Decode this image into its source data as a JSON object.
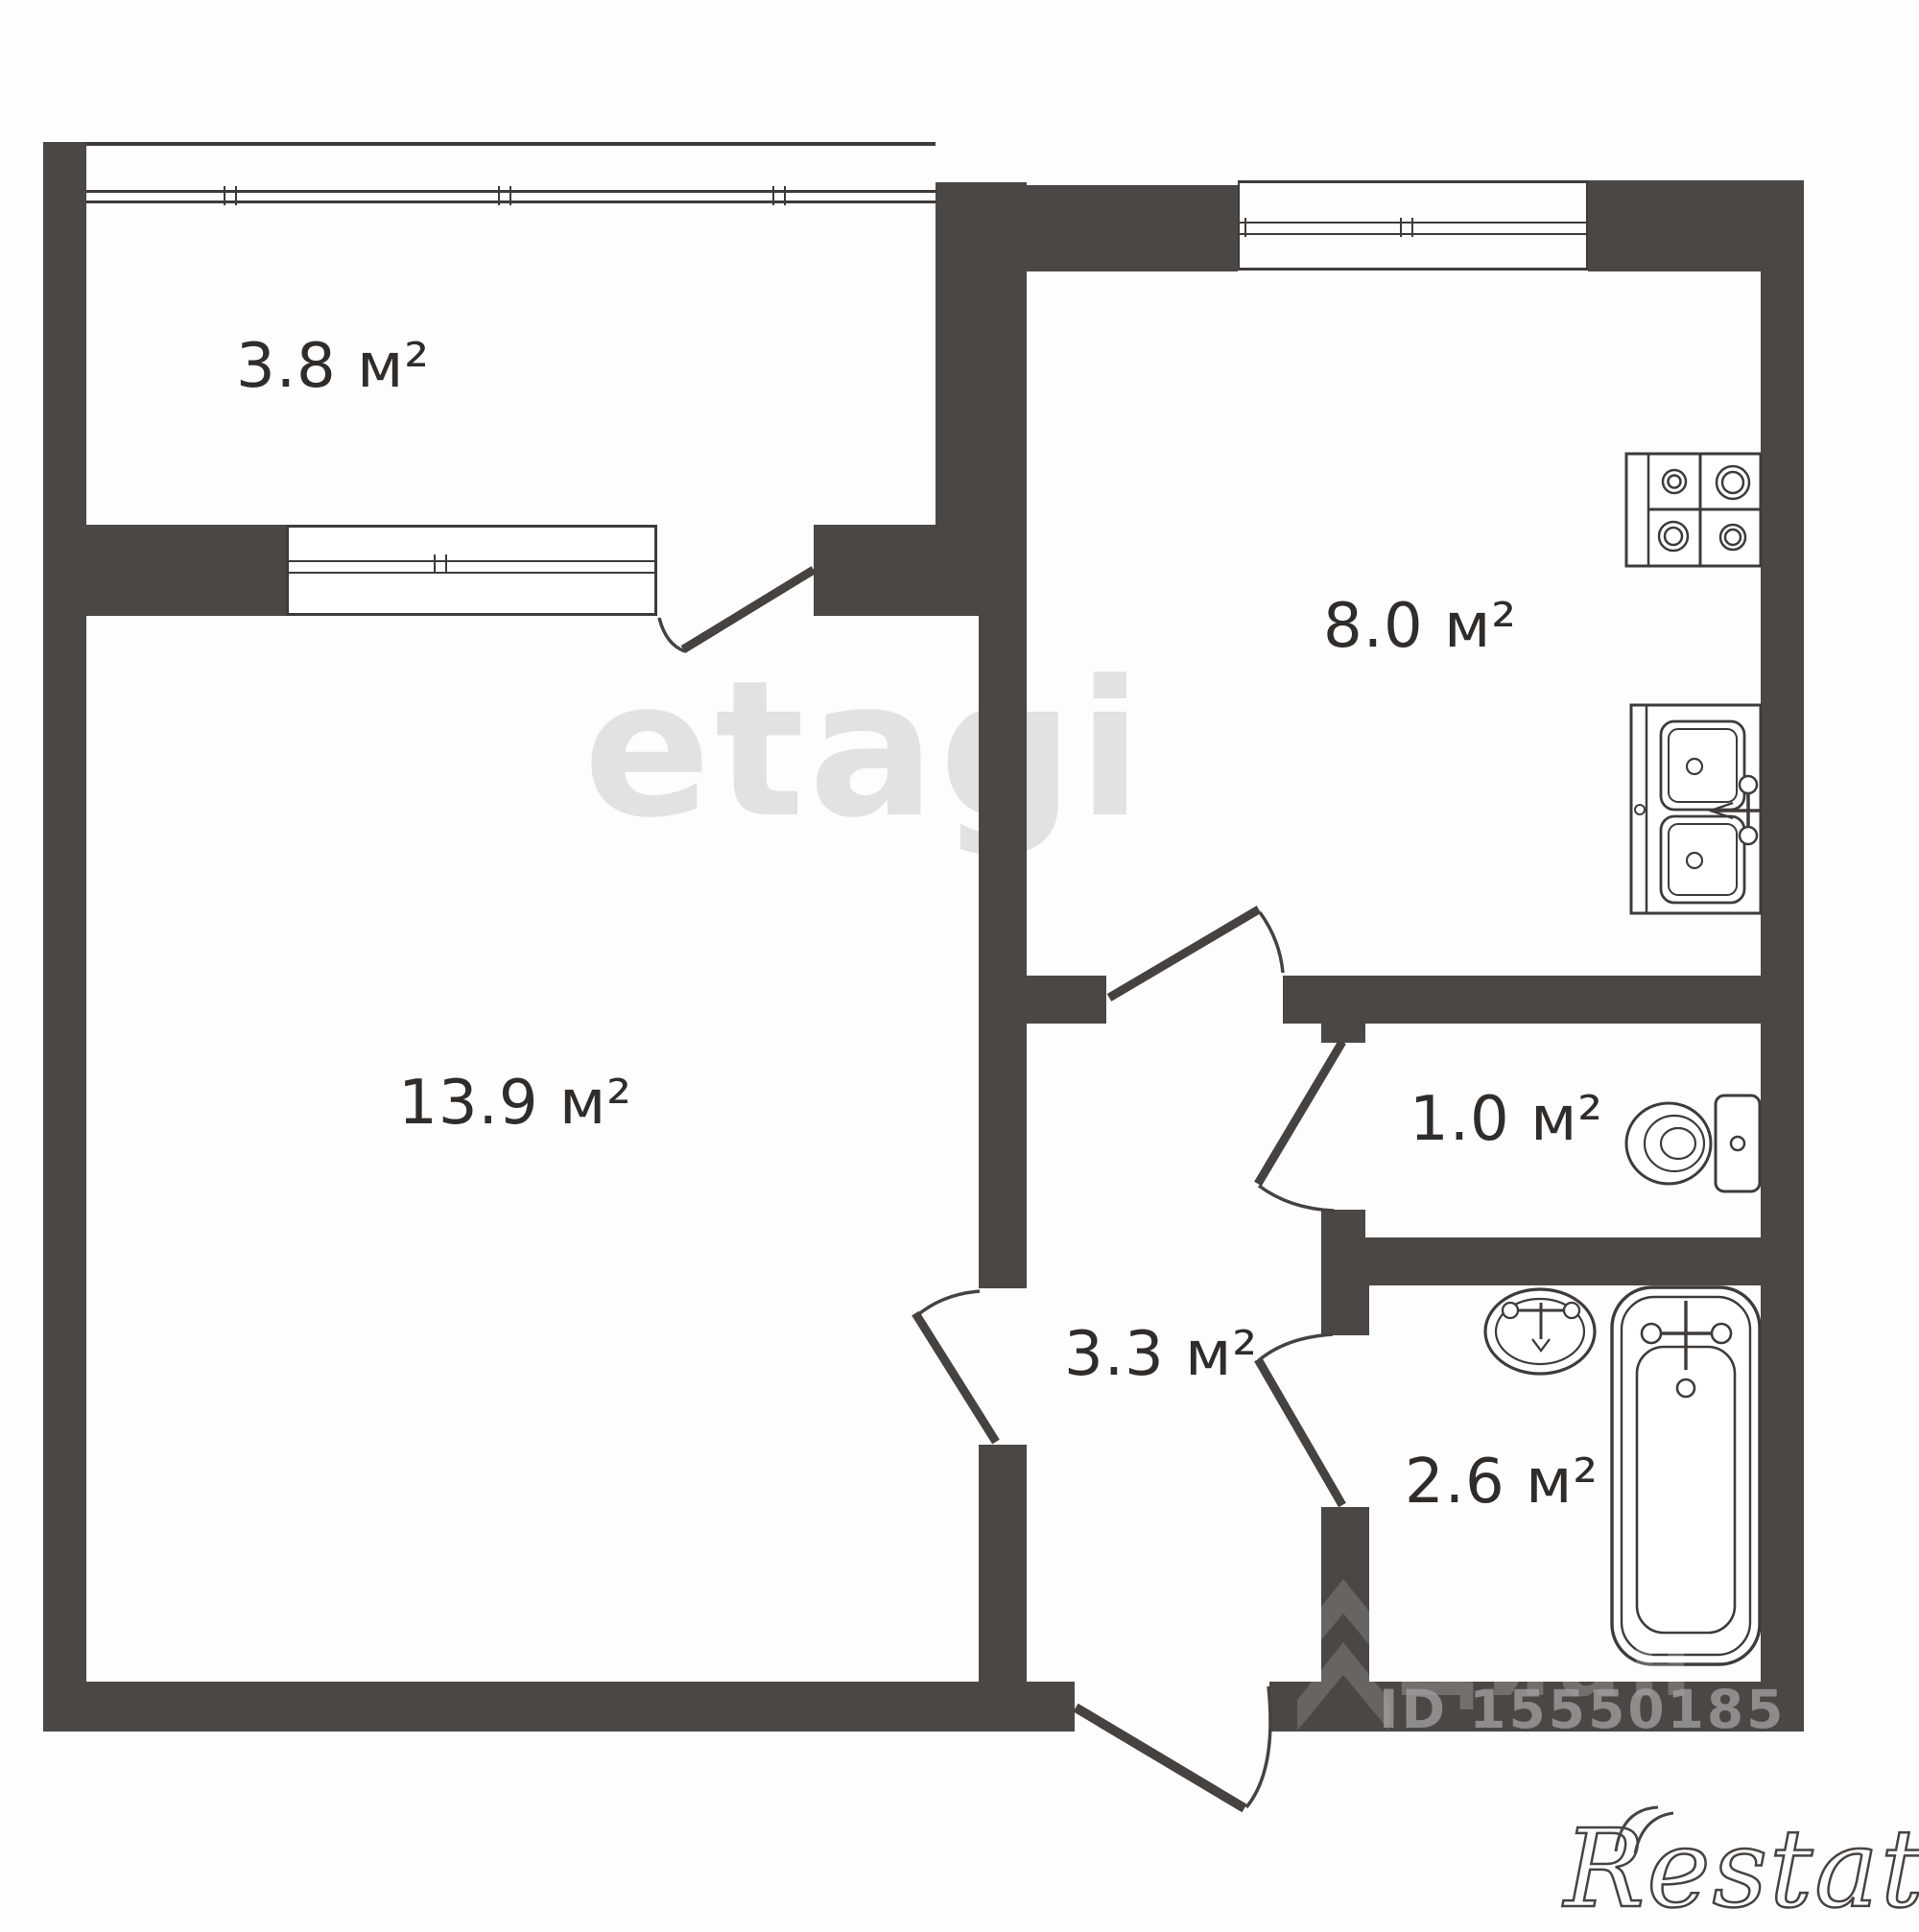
{
  "plan": {
    "rooms": {
      "balcony": {
        "label": "3.8 м²"
      },
      "kitchen": {
        "label": "8.0 м²"
      },
      "living_room": {
        "label": "13.9 м²"
      },
      "toilet": {
        "label": "1.0 м²"
      },
      "hallway": {
        "label": "3.3 м²"
      },
      "bathroom": {
        "label": "2.6 м²"
      }
    },
    "fixtures": [
      "stove",
      "kitchen-sink",
      "toilet",
      "wash-basin",
      "bathtub"
    ],
    "watermarks": {
      "etagi": "etagi",
      "cian": "Циан",
      "cian_id": "ID 15550185",
      "restate": "Restate"
    },
    "colors": {
      "wall": "#4b4744",
      "line": "#3e3b38",
      "label": "#2f2c2a"
    }
  }
}
